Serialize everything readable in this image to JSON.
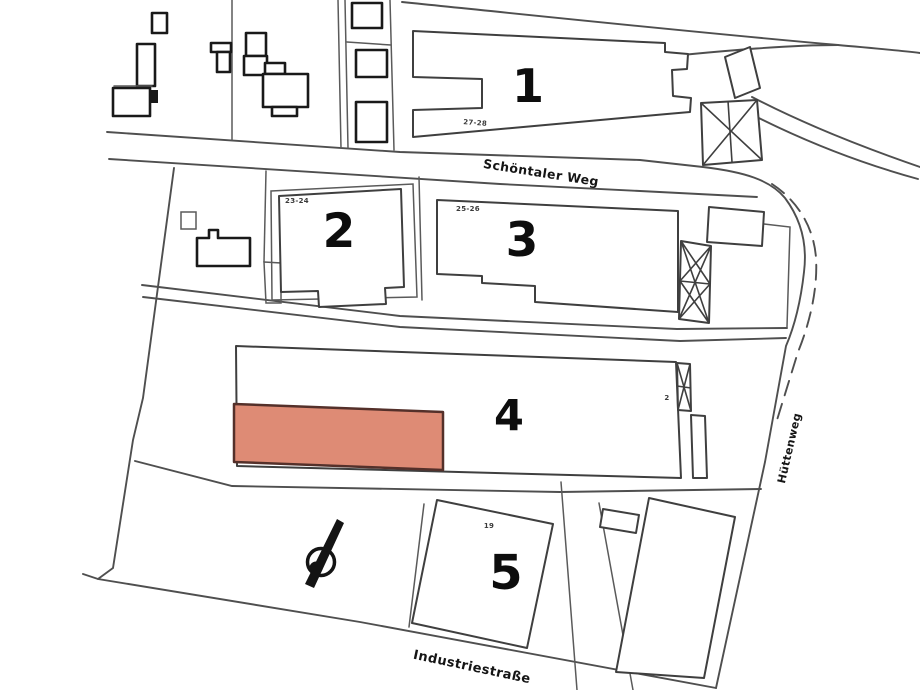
{
  "plan": {
    "title": "site-plan-scan",
    "streets": {
      "schoentaler_weg": "Schöntaler Weg",
      "huettenweg": "Hüttenweg",
      "industriestrasse": "Industriestraße"
    },
    "buildings": {
      "b1": {
        "number": "1",
        "sub": "27-28"
      },
      "b2": {
        "number": "2",
        "sub": "23-24"
      },
      "b3": {
        "number": "3",
        "sub": "25-26"
      },
      "b4": {
        "number": "4",
        "sub": "2"
      },
      "b5": {
        "number": "5",
        "sub": "19"
      }
    },
    "icons": {
      "compass": "compass-needle-icon"
    },
    "colors": {
      "highlight_fill": "#de8b75",
      "highlight_stroke": "#54302a",
      "line": "#4f4f4f",
      "dark": "#191919",
      "background": "#ffffff"
    }
  }
}
